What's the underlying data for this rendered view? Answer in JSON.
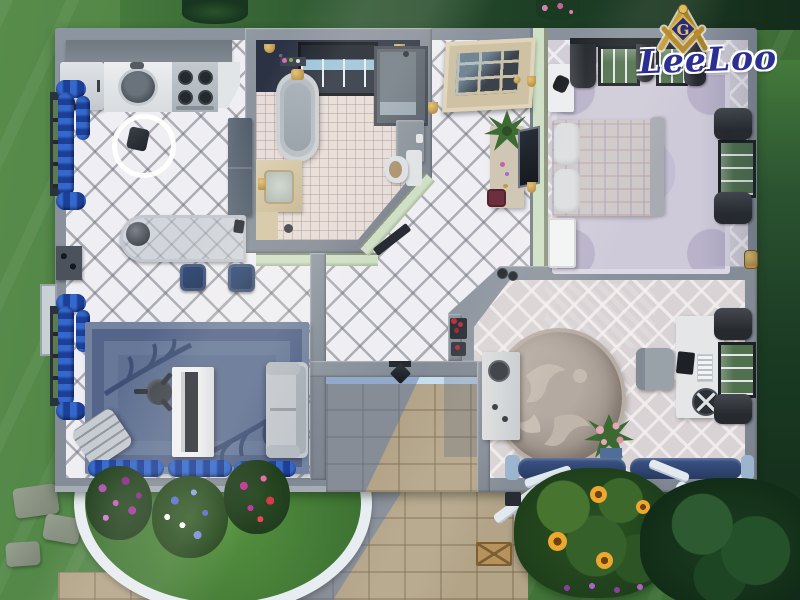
{
  "watermark": {
    "creator_name": "LeeLoo",
    "emblem_letter": "G",
    "emblem_title": "square and compasses emblem"
  },
  "palette": {
    "wall_grey": "#828a94",
    "floor_white": "#efeef3",
    "accent_navy": "#2a3c64",
    "curtain_blue": "#2859b8",
    "hall_wall_green": "#cfe0c6",
    "bathroom_accent_wall": "#2b3243",
    "path_tan": "#b3a488",
    "grass_green": "#4a7c41",
    "tree_dark": "#1b3d20",
    "porch_trim_blue": "#c6ddee",
    "logo_navy": "#2b2f92",
    "logo_gold": "#caa23d"
  },
  "rooms": {
    "kitchen": {
      "label": "Kitchen and dining"
    },
    "living": {
      "label": "Living room"
    },
    "bathroom": {
      "label": "Bathroom"
    },
    "hall": {
      "label": "Entry hall"
    },
    "bedroom": {
      "label": "Bedroom"
    },
    "study": {
      "label": "Study"
    },
    "porch": {
      "label": "Porch"
    },
    "garden": {
      "label": "Gardens"
    }
  },
  "items": {
    "fridge": "Refrigerator",
    "stove": "Stove with four burners",
    "kitchen_sink": "Counter with sink",
    "cabinets": "Upper cabinets",
    "pantry": "Tall cabinet",
    "trash": "Trash can on round mat",
    "bar": "Curved bar counter",
    "coffee": "Coffee machine",
    "stool": "Navy bar stool",
    "piano": "White upright piano",
    "piano_stool": "Piano stool",
    "rocking_chair": "Rocking chair",
    "grey_sofa": "Grey sofa",
    "living_rug": "Blue floral rug",
    "tub": "Clawfoot bathtub",
    "vanity": "Vanity sink",
    "shower": "Shower stall",
    "toilet": "Toilet",
    "front_door": "Glazed wooden door",
    "console": "Console table with plant",
    "mirror": "Leaning mirror",
    "red_stool": "Red vanity stool",
    "bed": "Double bed with plaid cover",
    "bedroom_rug": "Pale ornate rug",
    "nightstand": "White nightstand",
    "bedroom_door": "White bedroom door",
    "drape_window": "Window with dark drapes",
    "blue_window": "Window with blue ruffled curtains",
    "round_rug": "Round damask rug",
    "desk": "Desk with computer",
    "desk_chair": "Desk chair",
    "craft_cabinet": "Cabinet with gramophone",
    "study_plant": "Potted plant with pink flowers",
    "navy_sofa": "Navy sofa",
    "porch_lamp": "Porch lantern",
    "crate": "Wooden crate",
    "flower_bed": "Curved flower bed",
    "sunflower_bed": "Sunflower garden",
    "tree": "Tree",
    "sconce": "Wall sconce",
    "light_switch": "Light switch",
    "bath_door": "Open bathroom door",
    "plaid_curtains": "Blue ruffled valance",
    "clutter": "Decor clutter"
  }
}
